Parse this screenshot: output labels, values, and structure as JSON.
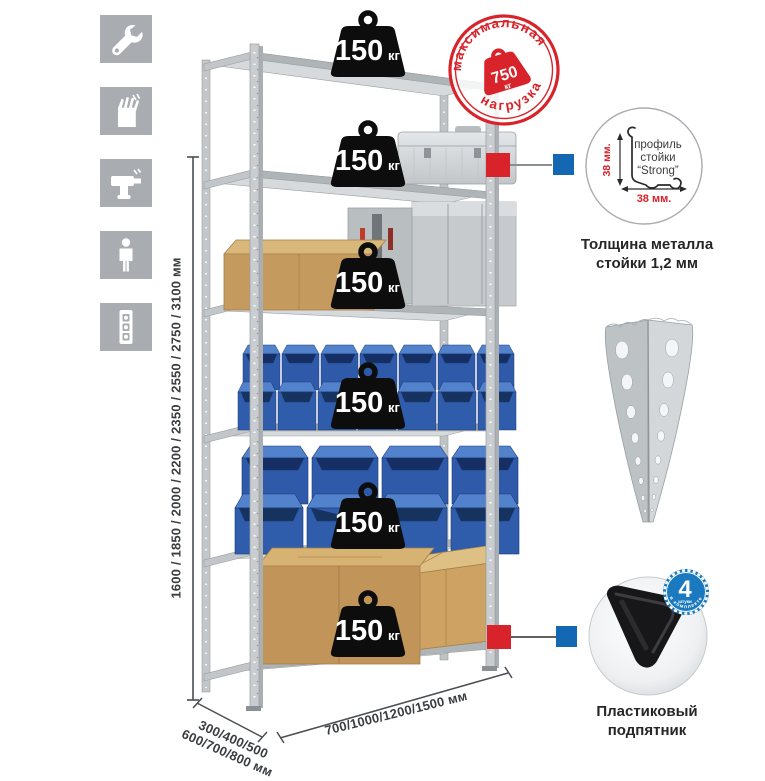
{
  "sidebar": {
    "icons": [
      {
        "name": "wrench"
      },
      {
        "name": "gloves"
      },
      {
        "name": "drill"
      },
      {
        "name": "person"
      },
      {
        "name": "level"
      }
    ]
  },
  "dimensions": {
    "height": "1600 / 1850 / 2000 / 2200 / 2350 / 2550 / 2750 / 3100 мм",
    "width": "700/1000/1200/1500 мм",
    "depth_line1": "300/400/500",
    "depth_line2": "600/700/800 мм"
  },
  "shelf": {
    "levels": 6,
    "weight_value": "150",
    "weight_unit": "кг"
  },
  "max_load": {
    "arc_top": "максимальная",
    "arc_bottom": "нагрузка",
    "value": "750",
    "unit": "кг"
  },
  "profile": {
    "line1": "профиль",
    "line2": "стойки",
    "line3": "“Strong”",
    "dim_v": "38 мм.",
    "dim_h": "38 мм.",
    "caption1": "Толщина металла",
    "caption2": "стойки 1,2 мм"
  },
  "foot": {
    "badge_value": "4",
    "badge_word": "штуки",
    "badge_arc": "в комплекте",
    "caption1": "Пластиковый",
    "caption2": "подпятник"
  },
  "colors": {
    "accent_red": "#d8232a",
    "accent_blue": "#1468b3",
    "bin_blue": "#2e5aa9",
    "badge_blue": "#1b79bf",
    "metal_gray": "#c9cdd0"
  }
}
